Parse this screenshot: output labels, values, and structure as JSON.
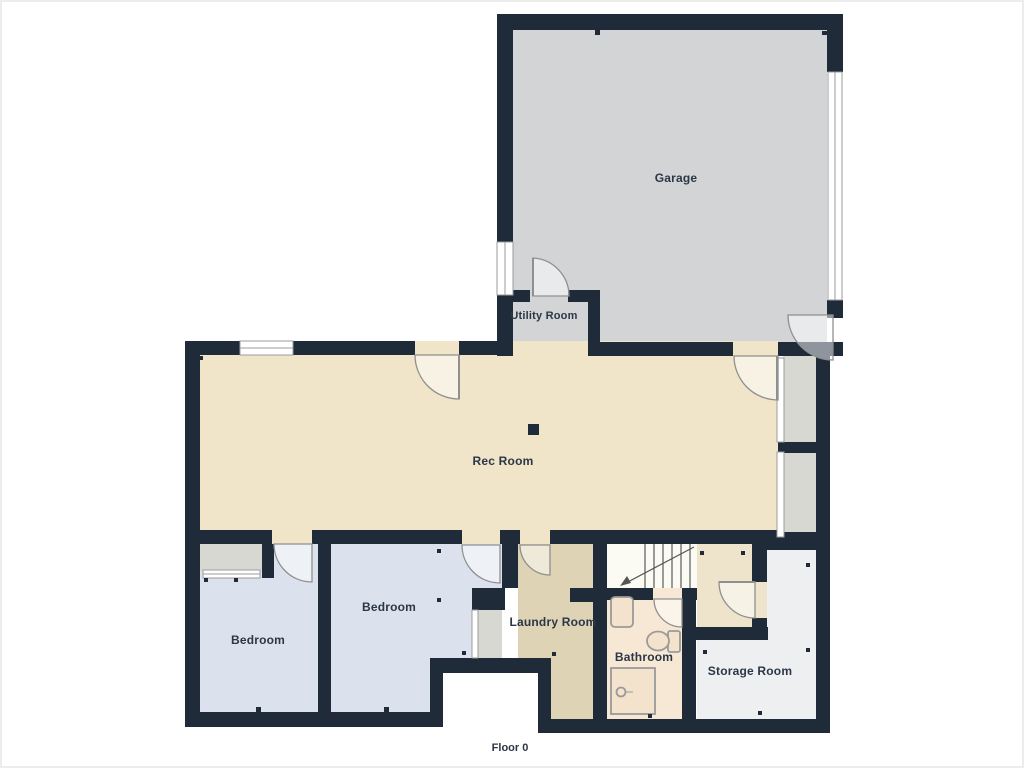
{
  "title": "Floor plan",
  "floor_label": "Floor 0",
  "rooms": [
    {
      "id": "garage",
      "label": "Garage"
    },
    {
      "id": "utility-room",
      "label": "Utility Room"
    },
    {
      "id": "rec-room",
      "label": "Rec Room"
    },
    {
      "id": "bedroom-1",
      "label": "Bedroom"
    },
    {
      "id": "bedroom-2",
      "label": "Bedroom"
    },
    {
      "id": "laundry-room",
      "label": "Laundry Room"
    },
    {
      "id": "bathroom",
      "label": "Bathroom"
    },
    {
      "id": "storage-room",
      "label": "Storage Room"
    }
  ],
  "palette": {
    "wall": "#1f2b39",
    "garage_floor": "#d3d4d6",
    "rec_floor": "#f0e5c9",
    "bedroom_floor": "#dce2ed",
    "closet_floor": "#d8d8d3",
    "laundry_floor": "#ded3b5",
    "bathroom_floor": "#f7e8d6",
    "storage_floor": "#edeff1",
    "hallway_floor": "#eee4cc",
    "stairs_floor": "#fbfaf3",
    "fixture_fill": "#f3e2cc",
    "door_line": "#8f8f8f",
    "label_color": "#2b3647"
  }
}
